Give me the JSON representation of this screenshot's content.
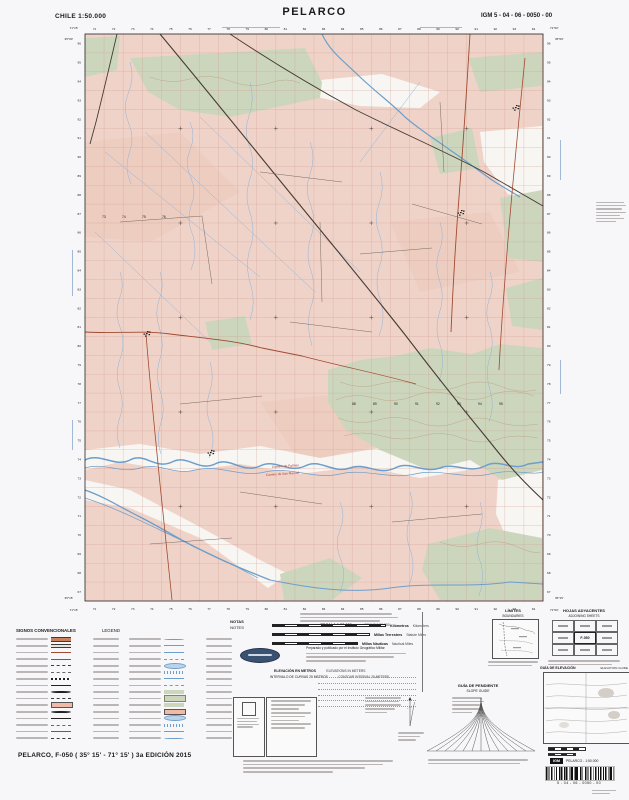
{
  "header": {
    "country_scale": "CHILE  1:50.000",
    "title": "PELARCO",
    "sheet_code": "IGM 5 - 04 - 06 - 0050 - 00"
  },
  "footer": {
    "edition": "PELARCO, F-050 ( 35° 15' - 71° 15' ) 3a EDICIÓN 2015"
  },
  "colors": {
    "land": "#f0d3c8",
    "land_deep": "#ecc9bc",
    "vegetation": "#ccd6bd",
    "flood": "#f8f6f2",
    "water": "#6d9ecb",
    "stream": "#8fb4da",
    "grid": "#cf9d93",
    "road_dark": "#453b36",
    "road_red": "#a04a31",
    "road_thin": "#6b5d55",
    "contour": "#b98d6b",
    "label_red": "#b03a2e",
    "blue_note": "#5b86bb"
  },
  "notes": {
    "es": "NOTAS",
    "en": "NOTES",
    "prepared_line": "Preparado y publicado por el Instituto Geográfico Militar"
  },
  "scalebars": {
    "title_es": "ESCALA 1:50.000",
    "title_en": "SCALE 1:50.000",
    "bars": [
      {
        "es": "Kilómetros",
        "en": "Kilometers",
        "w": 112
      },
      {
        "es": "Millas Terrestres",
        "en": "Statute Miles",
        "w": 96
      },
      {
        "es": "Millas Náuticas",
        "en": "Nautical Miles",
        "w": 84
      }
    ]
  },
  "elevation": {
    "es": "ELEVACIÓN EN METROS",
    "en": "ELEVATIONS IN METERS",
    "interval_es": "INTERVALO DE CURVAS 25 METROS",
    "interval_en": "CONTOUR INTERVAL 25 METERS"
  },
  "boxes": {
    "limites_es": "LÍMITES",
    "limites_en": "BOUNDARIES",
    "hojas_es": "HOJAS ADYACENTES",
    "hojas_en": "ADJOINING SHEETS",
    "center_sheet": "F-050",
    "guia_elev_es": "GUÍA DE ELEVACIÓN",
    "guia_elev_en": "ELEVATION GUIDE",
    "guia_pend_es": "GUÍA DE PENDIENTE",
    "guia_pend_en": "SLOPE GUIDE"
  },
  "barcode": {
    "igm": "IGM",
    "label": "PELARCO - 1:50.000",
    "number": "5 - 04 - 06 - 0050 - 00"
  },
  "legend": {
    "title_es": "SIGNOS CONVENCIONALES",
    "title_en": "LEGEND",
    "col1_syms": [
      "road4",
      "road3",
      "roadred",
      "roadredthin",
      "dash",
      "dashthin",
      "rail",
      "rail2",
      "dot",
      "dash",
      "builtup",
      "dot",
      "rail2",
      "dashthin",
      "roadredthin",
      "dash"
    ],
    "col2_syms": [
      "river",
      "river2",
      "canal",
      "canaldash",
      "lake",
      "marsh",
      "river2",
      "canaldash",
      "veg",
      "orchard",
      "veg",
      "builtup",
      "lake",
      "marsh",
      "canal",
      "river"
    ]
  },
  "map": {
    "ticks_top": [
      "71",
      "72",
      "73",
      "74",
      "75",
      "76",
      "77",
      "78",
      "79",
      "80",
      "81",
      "82",
      "83",
      "84",
      "85",
      "86",
      "87",
      "88",
      "89",
      "90",
      "91",
      "92",
      "93",
      "94"
    ],
    "ticks_left": [
      "96",
      "95",
      "94",
      "93",
      "92",
      "91",
      "90",
      "89",
      "88",
      "87",
      "86",
      "85",
      "84",
      "83",
      "82",
      "81",
      "80",
      "79",
      "78",
      "77",
      "76",
      "75",
      "74",
      "73",
      "72",
      "71",
      "70",
      "69",
      "68",
      "67"
    ],
    "corner_labels": {
      "top_left_lon": "71°15'",
      "top_right_lon": "71°00'",
      "top_lat": "35°00'",
      "bottom_lat": "35°15'"
    },
    "grid_numbers_row1": {
      "y": 383,
      "start_x": 292,
      "step": 21,
      "values": [
        "88",
        "89",
        "90",
        "91",
        "92",
        "93",
        "94",
        "95"
      ]
    },
    "grid_numbers_row2": {
      "y": 196,
      "start_x": 42,
      "step": 20,
      "values": [
        "73",
        "74",
        "75",
        "76"
      ]
    },
    "road_labels": [
      {
        "text": "Camino de Palmas",
        "x": 212,
        "y": 446,
        "rot": -4
      },
      {
        "text": "Camino de San Manuel",
        "x": 206,
        "y": 454,
        "rot": -4
      }
    ],
    "deep_patches": [
      "25,120 120,110 180,170 90,220 25,215",
      "330,200 430,190 460,250 360,270",
      "200,380 300,370 340,420 240,440"
    ],
    "whites": [
      "240,60 322,52 380,70 360,86 300,84 252,74",
      "420,110 482,104 482,182 448,172 424,140",
      "25,428 80,422 140,432 200,424 260,436 320,426 380,438 440,430 482,436 482,452 420,446 360,456 300,444 240,452 180,442 120,450 60,440 25,448",
      "25,458 70,468 140,505 200,538 228,552 208,566 140,516 70,486 25,478",
      "438,458 482,448 482,540 450,524 436,492"
    ],
    "greens": [
      "70,36 245,26 262,60 260,76 170,95 120,88 88,70",
      "25,16 60,14 57,48 25,55",
      "408,36 482,30 482,64 420,70",
      "440,176 482,168 482,240 448,236",
      "446,266 482,256 482,308 452,304",
      "268,348 300,338 336,334 370,326 412,332 440,322 482,326 482,448 442,458 410,438 368,448 320,428 286,408 268,380",
      "368,522 430,506 482,516 482,578 380,578 362,548",
      "220,552 270,536 302,556 272,578 224,578",
      "145,300 185,294 192,322 152,328",
      "370,116 412,106 420,146 380,152"
    ],
    "canals": [
      "M45,130 L200,255",
      "M85,110 L255,270",
      "M140,95 L300,250",
      "M35,210 L150,320",
      "M360,60 L300,140"
    ],
    "streams": [
      "M70,40 q5,16 -2,32 q-6,15 1,30 q6,14 0,30 q-5,14 2,30",
      "M130,100 q6,14 0,28 q-6,14 1,28 q6,14 0,28 q-5,14 2,30 q5,16 -2,34",
      "M190,60 q5,18 -1,34 q-6,16 1,32 q6,16 -1,34 q-5,16 2,34 q5,18 -2,36 q-4,16 2,34 q5,16 -1,34",
      "M250,120 q6,16 0,32 q-6,16 1,32 q6,16 -1,34 q-5,16 2,34 q5,18 -2,36 q-4,16 2,36",
      "M320,150 q5,16 -1,32 q-6,16 1,32 q5,16 -1,32 q-5,16 2,34 q5,16 -2,34",
      "M380,200 q5,16 -1,30 q-5,14 1,30 q5,16 -1,32 q-5,16 2,34 q4,16 -2,34",
      "M430,250 q5,14 -1,28 q-5,14 1,28 q5,16 -1,32 q-4,14 1,30 q5,16 -1,32",
      "M100,250 q5,14 -1,28 q-5,14 1,30 q5,16 -1,32 q-4,16 2,32 q5,16 -1,32 q-4,14 1,28",
      "M150,340 q5,16 -1,32 q-5,16 2,32 q5,16 -2,32",
      "M280,480 q6,14 0,28 q-6,14 1,30 q6,16 -1,32",
      "M350,470 q5,14 -1,28 q-5,16 2,32 q5,16 -2,34",
      "M420,480 q5,14 -1,30 q-5,16 2,32 q4,14 -2,32",
      "M60,250 q5,14 -1,28 q-5,14 2,30 q5,16 -2,32 q-4,14 1,28 q5,16 -1,30 q-4,14 1,28"
    ],
    "rivers": [
      {
        "d": "M25,438 C40,430 55,446 70,438 C85,430 95,448 112,440 C128,432 138,450 155,442 C170,434 182,452 200,444 C215,436 228,452 245,444 C260,436 272,452 290,446 C305,440 318,454 335,446 C350,438 362,452 380,446 C395,440 408,452 425,444 C440,436 452,450 468,442 L483,440",
        "w": 1.5
      },
      {
        "d": "M25,446 C45,440 60,452 80,446 C100,440 115,454 135,448 C160,442 180,456 205,450 C230,444 255,458 280,452 C305,446 330,458 355,452 C380,446 405,458 430,452 C455,446 470,454 483,450",
        "w": 0.7
      },
      {
        "d": "M262,12 C270,30 285,40 300,55 C318,72 330,80 345,95 C360,108 372,115 390,128 C405,138 420,150 435,160 L460,175",
        "w": 1.2
      },
      {
        "d": "M25,468 C45,475 60,485 80,495 C100,505 115,515 135,525 C155,535 170,542 190,550 L210,558",
        "w": 1.3
      },
      {
        "d": "M25,476 C50,484 75,496 100,508 C125,520 150,532 175,544 L198,556",
        "w": 0.7
      },
      {
        "d": "M210,558 C250,566 290,572 330,566 C370,560 410,566 450,560 L483,562",
        "w": 1.0
      }
    ],
    "contours": [
      "M280,360 q20,8 40,2 q20,-6 40,2 q20,8 40,0 q20,-8 40,0 q18,8 36,4",
      "M276,378 q18,-8 38,-2 q20,6 40,-2 q20,-8 40,0 q20,8 40,-2 q18,-6 40,2",
      "M278,396 q20,8 40,2 q20,-6 40,2 q20,8 40,0 q20,-8 40,0 q16,6 40,2",
      "M284,414 q18,-6 38,0 q20,6 40,0 q20,-6 40,2 q20,8 40,0 q14,-4 36,0",
      "M380,520 q20,8 40,2 q20,-6 40,4 q14,6 20,4",
      "M90,55 q20,8 40,2 q20,-6 40,2 q20,8 40,2 q16,-6 30,0"
    ],
    "roads": [
      {
        "d": "M100,12 C140,60 182,112 226,166 C270,220 310,268 346,314 C378,356 402,386 430,420 C452,448 466,462 483,478",
        "c": "dark",
        "w": 1.1
      },
      {
        "d": "M170,12 C212,40 252,64 296,88 C340,110 382,128 424,150 L483,184",
        "c": "dark",
        "w": 0.9
      },
      {
        "d": "M57,12 C50,42 43,72 36,100 L30,122",
        "c": "dark",
        "w": 0.9
      },
      {
        "d": "M410,12 C407,62 404,112 400,162 C396,212 393,262 391,310",
        "c": "red",
        "w": 0.9
      },
      {
        "d": "M465,36 C459,96 453,156 448,218 C444,268 441,308 439,348",
        "c": "red",
        "w": 0.8
      },
      {
        "d": "M25,310 C56,312 82,308 110,312 C142,316 172,318 202,326 L242,334",
        "c": "red",
        "w": 0.9
      },
      {
        "d": "M86,312 C90,362 95,412 100,462 C104,502 108,542 112,578",
        "c": "red",
        "w": 0.8
      },
      {
        "d": "M242,334 C280,344 320,352 356,362",
        "c": "red",
        "w": 0.7
      },
      {
        "d": "M60,200 L142,194",
        "c": "thin",
        "w": 0.45
      },
      {
        "d": "M142,194 L152,262",
        "c": "thin",
        "w": 0.45
      },
      {
        "d": "M200,150 L282,160",
        "c": "thin",
        "w": 0.45
      },
      {
        "d": "M300,232 L372,226",
        "c": "thin",
        "w": 0.45
      },
      {
        "d": "M230,300 L312,310",
        "c": "thin",
        "w": 0.45
      },
      {
        "d": "M120,382 L202,374",
        "c": "thin",
        "w": 0.45
      },
      {
        "d": "M332,500 L422,492",
        "c": "thin",
        "w": 0.45
      },
      {
        "d": "M180,470 L262,482",
        "c": "thin",
        "w": 0.45
      },
      {
        "d": "M352,182 L422,202",
        "c": "thin",
        "w": 0.45
      },
      {
        "d": "M90,522 L172,516",
        "c": "thin",
        "w": 0.45
      },
      {
        "d": "M260,200 L262,280",
        "c": "thin",
        "w": 0.45
      },
      {
        "d": "M380,80 L384,150",
        "c": "thin",
        "w": 0.45
      }
    ],
    "towns": [
      {
        "x": 86,
        "y": 311
      },
      {
        "x": 455,
        "y": 85
      },
      {
        "x": 400,
        "y": 190
      },
      {
        "x": 150,
        "y": 430
      }
    ]
  }
}
